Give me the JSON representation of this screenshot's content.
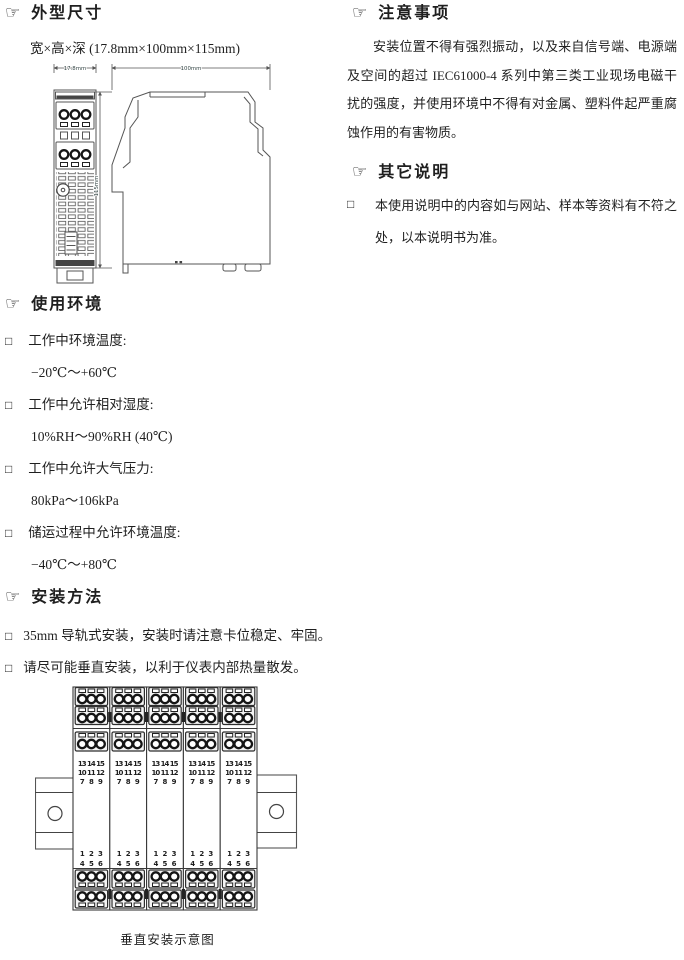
{
  "icons": {
    "pointer": "☞",
    "bullet": "□"
  },
  "dimensions_section": {
    "title": "外型尺寸",
    "subtitle": "宽×高×深 (17.8mm×100mm×115mm)",
    "labels": {
      "width": "17.8mm",
      "depth": "100mm",
      "height": "115mm"
    }
  },
  "environment_section": {
    "title": "使用环境",
    "items": [
      {
        "label": "工作中环境温度:",
        "value": "−20℃～+60℃"
      },
      {
        "label": "工作中允许相对湿度:",
        "value": "10%RH～90%RH (40℃)"
      },
      {
        "label": "工作中允许大气压力:",
        "value": "80kPa～106kPa"
      },
      {
        "label": "储运过程中允许环境温度:",
        "value": "−40℃～+80℃"
      }
    ]
  },
  "installation_section": {
    "title": "安装方法",
    "items": {
      "item1": "35mm 导轨式安装，安装时请注意卡位稳定、牢固。",
      "item2": "请尽可能垂直安装，以利于仪表内部热量散发。"
    },
    "diagram": {
      "caption": "垂直安装示意图",
      "top_terminals": {
        "row1": "13 14 15",
        "row2": "10 11 12",
        "row3": "7 8 9"
      },
      "bottom_terminals": {
        "row1": "1 2 3",
        "row2": "4 5 6"
      }
    }
  },
  "precautions_section": {
    "title": "注意事项",
    "body": "安装位置不得有强烈振动，以及来自信号端、电源端及空间的超过 IEC61000-4 系列中第三类工业现场电磁干扰的强度，并使用环境中不得有对金属、塑料件起严重腐蚀作用的有害物质。"
  },
  "other_section": {
    "title": "其它说明",
    "item": "本使用说明中的内容如与网站、样本等资料有不符之处，以本说明书为准。"
  }
}
